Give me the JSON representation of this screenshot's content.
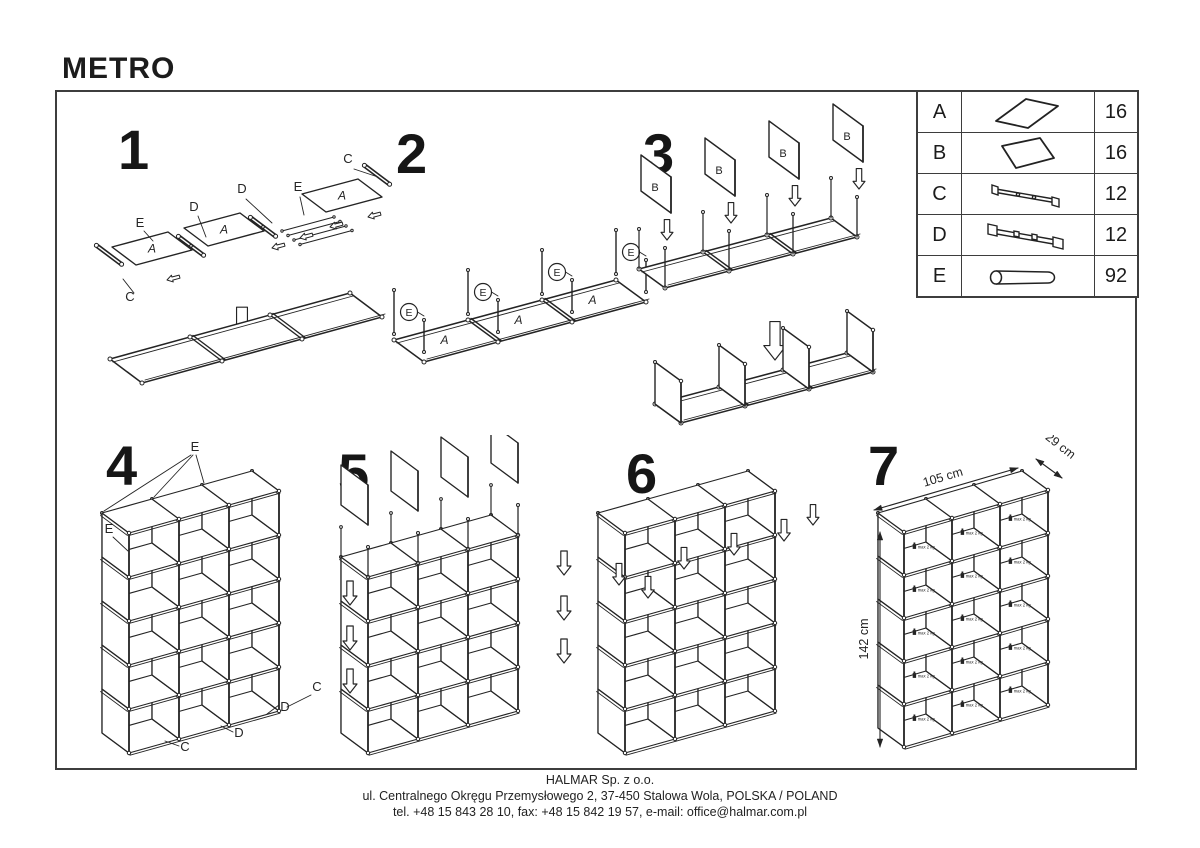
{
  "page": {
    "title": "METRO"
  },
  "parts_table": {
    "rows": [
      {
        "letter": "A",
        "qty": "16",
        "icon": "panel-a-icon"
      },
      {
        "letter": "B",
        "qty": "16",
        "icon": "panel-b-icon"
      },
      {
        "letter": "C",
        "qty": "12",
        "icon": "rail-c-icon"
      },
      {
        "letter": "D",
        "qty": "12",
        "icon": "rail-d-icon"
      },
      {
        "letter": "E",
        "qty": "92",
        "icon": "tube-e-icon"
      }
    ]
  },
  "steps": [
    {
      "label": "1"
    },
    {
      "label": "2"
    },
    {
      "label": "3"
    },
    {
      "label": "4"
    },
    {
      "label": "5"
    },
    {
      "label": "6"
    },
    {
      "label": "7"
    }
  ],
  "diagram_labels": {
    "panel_a": "A",
    "panel_b": "B",
    "rail_c": "C",
    "rail_d": "D",
    "tube_e": "E",
    "max_load": "max 2 kg"
  },
  "dimensions": {
    "width": "105 cm",
    "depth": "29 cm",
    "height": "142 cm"
  },
  "footer": {
    "line1": "HALMAR Sp. z o.o.",
    "line2": "ul. Centralnego Okręgu Przemysłowego 2, 37-450 Stalowa Wola, POLSKA / POLAND",
    "line3": "tel. +48 15 843 28 10, fax: +48 15 842 19 57, e-mail: office@halmar.com.pl"
  }
}
